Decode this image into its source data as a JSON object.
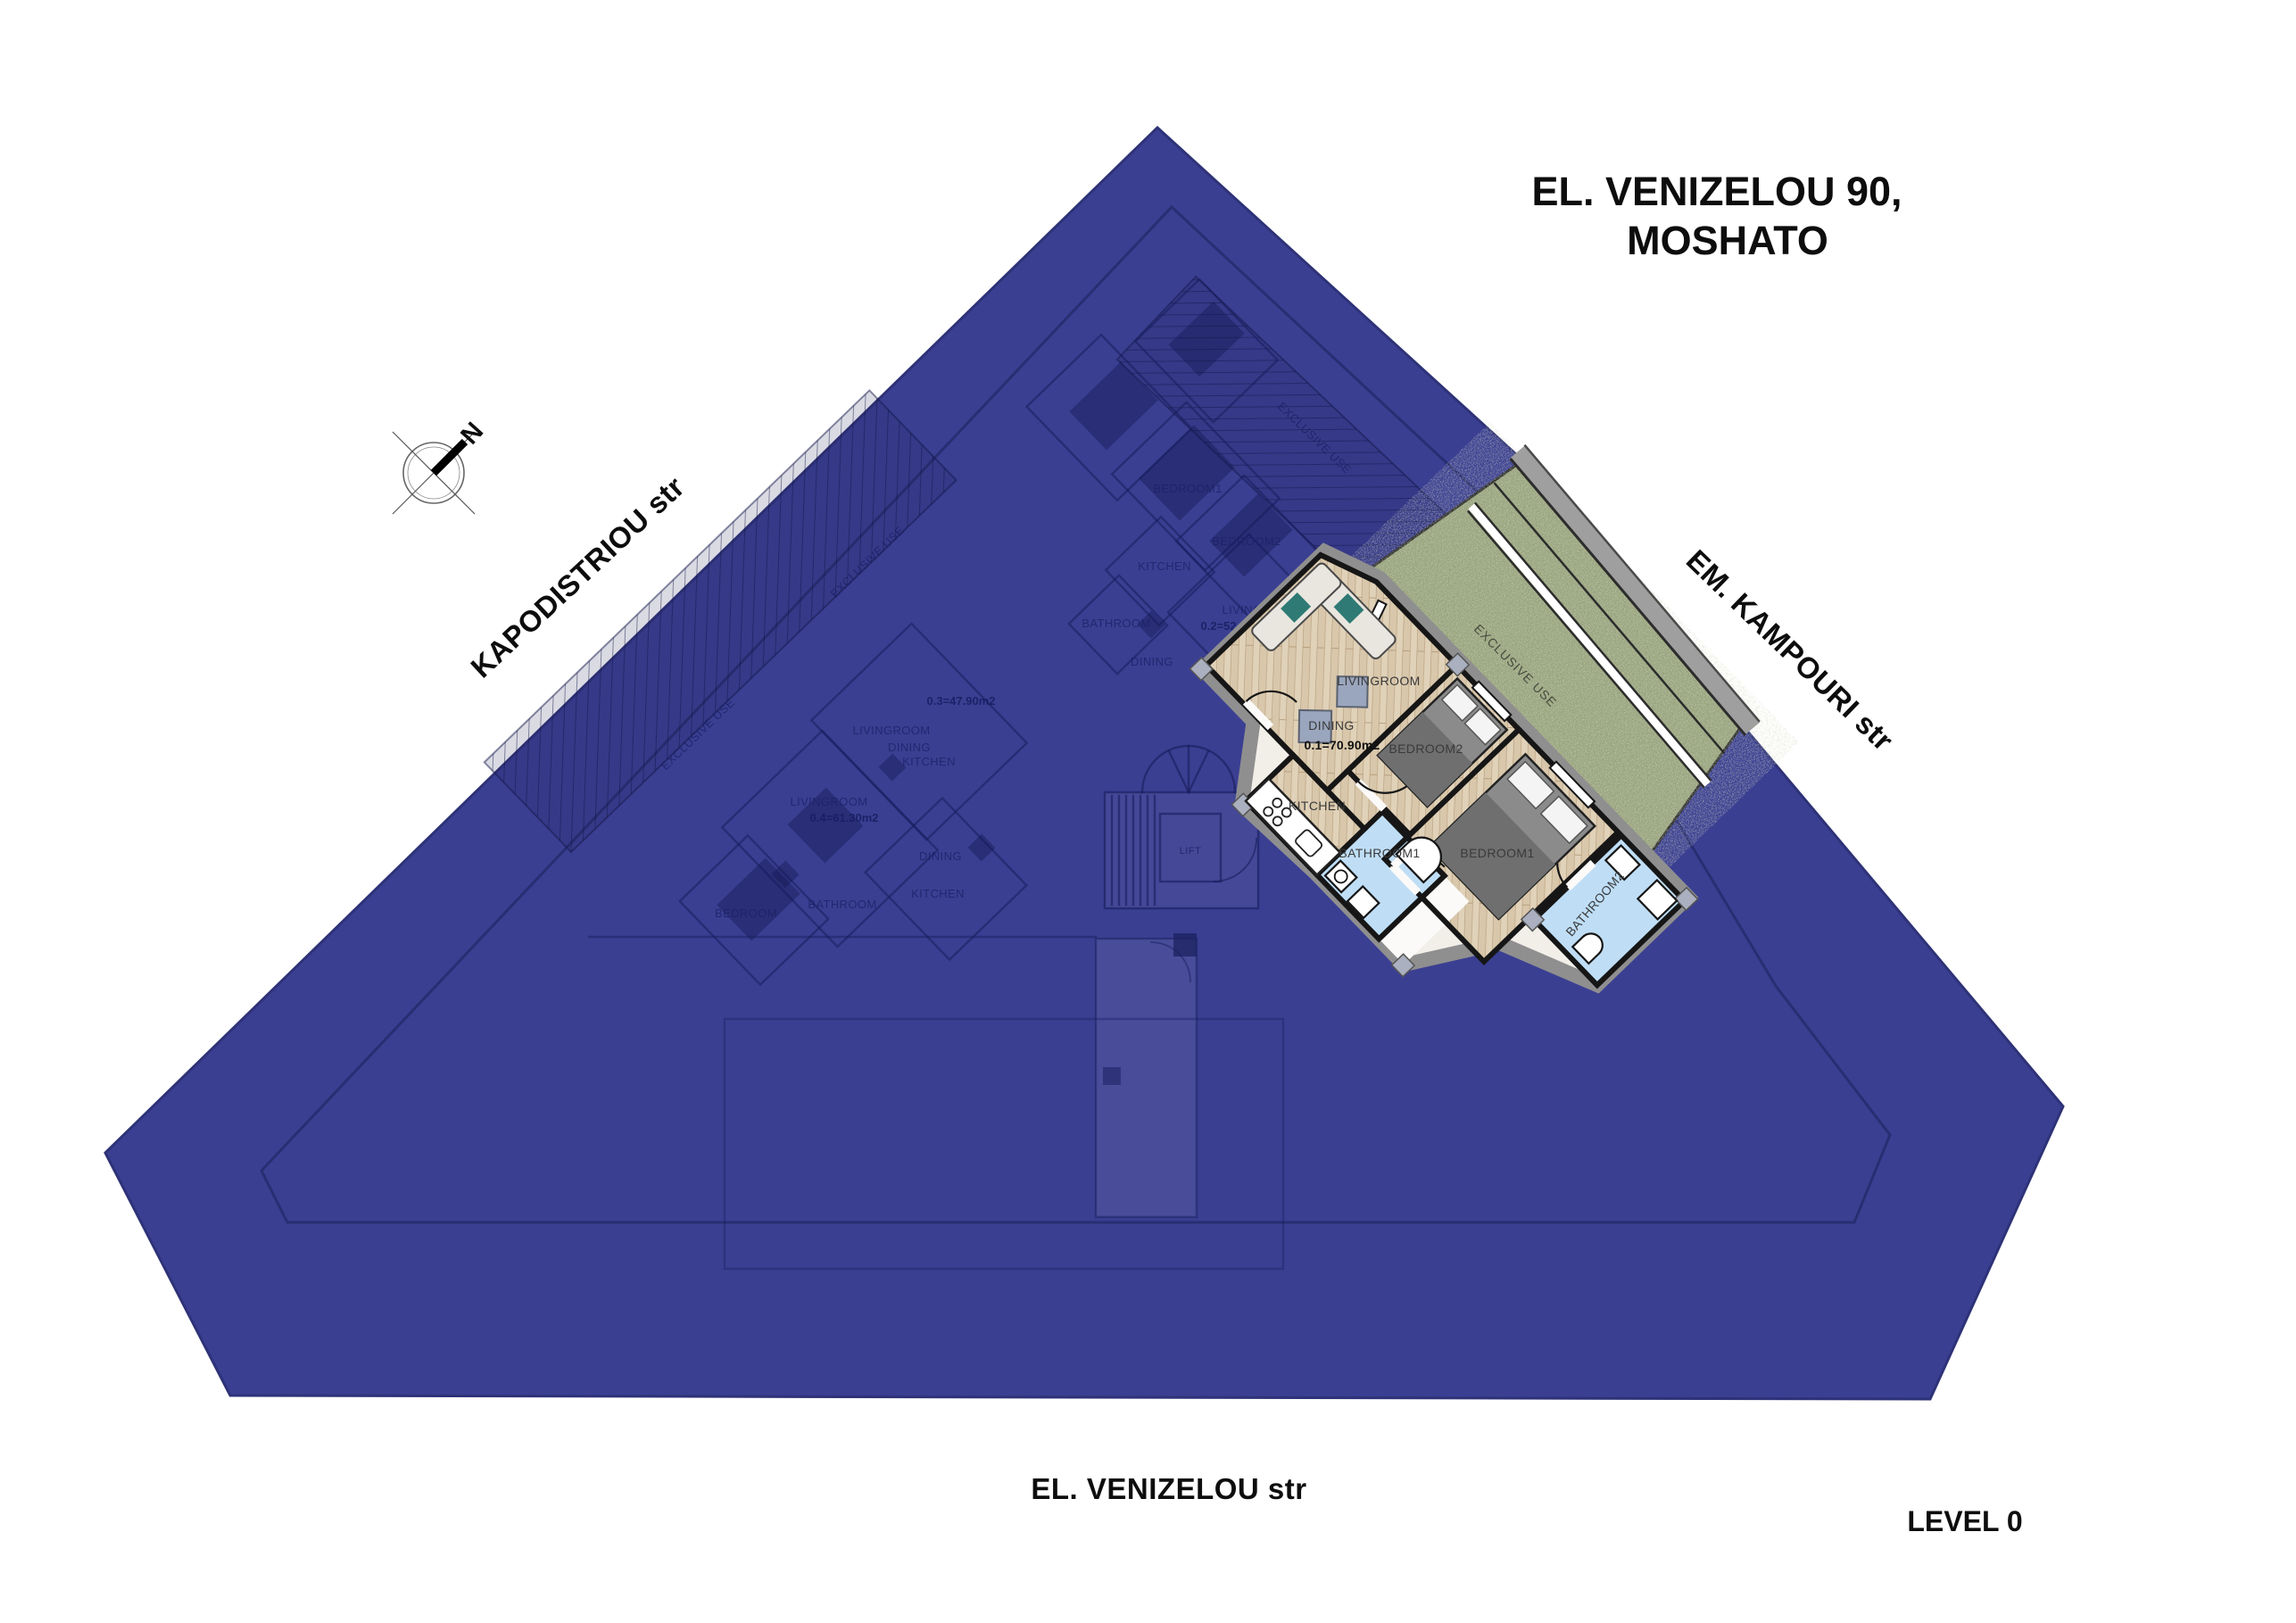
{
  "title": {
    "line1": "EL. VENIZELOU 90,",
    "line2": "MOSHATO"
  },
  "streets": {
    "kapodistriou": "KAPODISTRIOU str",
    "kampouri": "EM. KAMPOURI str",
    "venizelou": "EL. VENIZELOU str"
  },
  "level_label": "LEVEL 0",
  "compass_north": "N",
  "highlighted_unit": {
    "area_label": "0.1=70.90m2",
    "livingroom": "LIVINGROOM",
    "dining": "DINING",
    "kitchen": "KITCHEN",
    "bathroom1": "BATHROOM1",
    "bathroom2": "BATHROOM2",
    "bedroom1": "BEDROOM1",
    "bedroom2": "BEDROOM2",
    "exclusive_use": "EXCLUSIVE USE"
  },
  "overlay_plan": {
    "labels": [
      {
        "text": "EXCLUSIVE USE"
      },
      {
        "text": "EXCLUSIVE USE"
      },
      {
        "text": "EXCLUSIVE USE"
      },
      {
        "text": "BEDROOM1"
      },
      {
        "text": "BEDROOM2"
      },
      {
        "text": "KITCHEN"
      },
      {
        "text": "BATHROOM"
      },
      {
        "text": "LIVINGROOM"
      },
      {
        "text": "0.2=52.80m2"
      },
      {
        "text": "DINING"
      },
      {
        "text": "0.3=47.90m2"
      },
      {
        "text": "LIVINGROOM"
      },
      {
        "text": "DINING"
      },
      {
        "text": "KITCHEN"
      },
      {
        "text": "LIVINGROOM"
      },
      {
        "text": "0.4=61.30m2"
      },
      {
        "text": "BATHROOM"
      },
      {
        "text": "BEDROOM"
      },
      {
        "text": "DINING"
      },
      {
        "text": "KITCHEN"
      },
      {
        "text": "LIFT"
      }
    ]
  },
  "colors": {
    "site_blue": "#3b3f92",
    "site_edge": "#2e3277",
    "wood_floor": "#d8c7ab",
    "bathroom_floor": "#bfdef6",
    "grass_green": "#98a37e",
    "wall_black": "#161616",
    "outer_band_gray": "#8f8f8f",
    "sidewalk_gray": "#9f9f9f",
    "faint_plan_ink": "#1b2166"
  }
}
